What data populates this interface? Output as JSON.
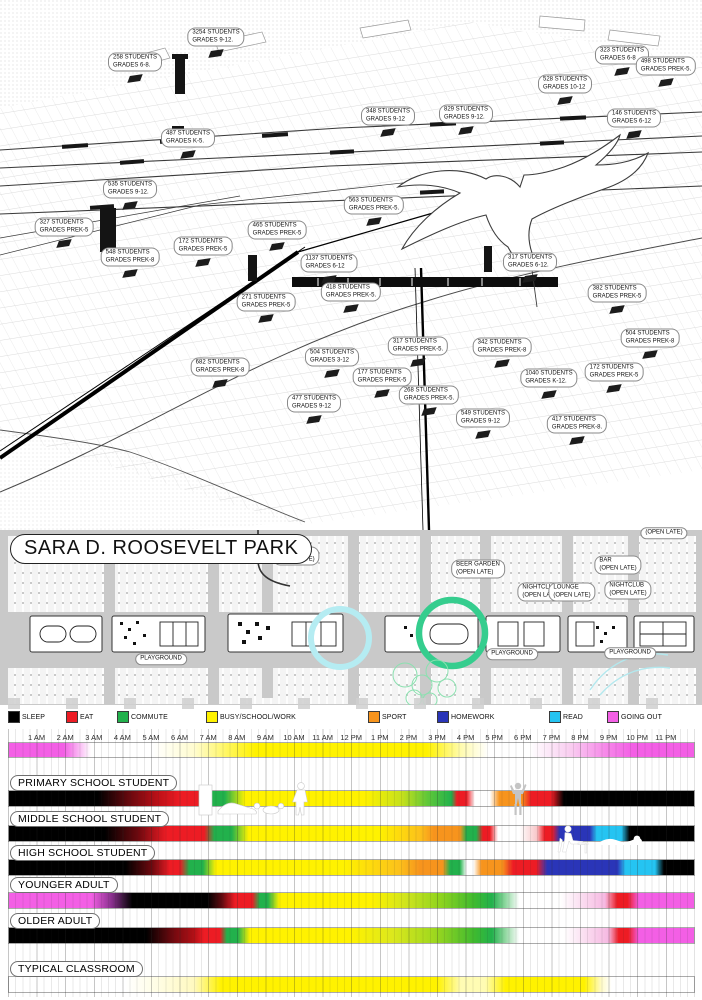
{
  "map": {
    "schools": [
      {
        "students": "3254 STUDENTS",
        "grades": "GRADES 9-12.",
        "x": 216,
        "y": 37
      },
      {
        "students": "258 STUDENTS",
        "grades": "GRADES 6-8.",
        "x": 135,
        "y": 62
      },
      {
        "students": "487 STUDENTS",
        "grades": "GRADES K-5.",
        "x": 188,
        "y": 138
      },
      {
        "students": "535 STUDENTS",
        "grades": "GRADES 9-12.",
        "x": 130,
        "y": 189
      },
      {
        "students": "327 STUDENTS",
        "grades": "GRADES PREK-5",
        "x": 64,
        "y": 227
      },
      {
        "students": "548 STUDENTS",
        "grades": "GRADES PREK-8",
        "x": 130,
        "y": 257
      },
      {
        "students": "172 STUDENTS",
        "grades": "GRADES PREK-5",
        "x": 203,
        "y": 246
      },
      {
        "students": "465 STUDENTS",
        "grades": "GRADES PREK-5",
        "x": 277,
        "y": 230
      },
      {
        "students": "1137 STUDENTS",
        "grades": "GRADES 6-12",
        "x": 329,
        "y": 263
      },
      {
        "students": "418 STUDENTS",
        "grades": "GRADES PREK-5.",
        "x": 351,
        "y": 292
      },
      {
        "students": "348 STUDENTS",
        "grades": "GRADES 9-12",
        "x": 388,
        "y": 116
      },
      {
        "students": "829 STUDENTS",
        "grades": "GRADES 9-12.",
        "x": 466,
        "y": 114
      },
      {
        "students": "528 STUDENTS",
        "grades": "GRADES 10-12",
        "x": 565,
        "y": 84
      },
      {
        "students": "323 STUDENTS",
        "grades": "GRADES 6-8",
        "x": 622,
        "y": 55
      },
      {
        "students": "498 STUDENTS",
        "grades": "GRADES PREK-5.",
        "x": 666,
        "y": 66
      },
      {
        "students": "146 STUDENTS",
        "grades": "GRADES 6-12",
        "x": 634,
        "y": 118
      },
      {
        "students": "563 STUDENTS",
        "grades": "GRADES PREK-5.",
        "x": 374,
        "y": 205
      },
      {
        "students": "317 STUDENTS",
        "grades": "GRADES 6-12.",
        "x": 530,
        "y": 262
      },
      {
        "students": "271 STUDENTS",
        "grades": "GRADES PREK-5",
        "x": 266,
        "y": 302
      },
      {
        "students": "682 STUDENTS",
        "grades": "GRADES PREK-8",
        "x": 220,
        "y": 367
      },
      {
        "students": "504 STUDENTS",
        "grades": "GRADES 3-12",
        "x": 332,
        "y": 357
      },
      {
        "students": "477 STUDENTS",
        "grades": "GRADES 9-12",
        "x": 314,
        "y": 403
      },
      {
        "students": "382 STUDENTS",
        "grades": "GRADES PREK-5",
        "x": 617,
        "y": 293
      },
      {
        "students": "504 STUDENTS",
        "grades": "GRADES PREK-8",
        "x": 650,
        "y": 338
      },
      {
        "students": "172 STUDENTS",
        "grades": "GRADES PREK-5",
        "x": 614,
        "y": 372
      },
      {
        "students": "317 STUDENTS",
        "grades": "GRADES PREK-5.",
        "x": 418,
        "y": 346
      },
      {
        "students": "342 STUDENTS",
        "grades": "GRADES PREK-8",
        "x": 502,
        "y": 347
      },
      {
        "students": "177 STUDENTS",
        "grades": "GRADES PREK-5",
        "x": 382,
        "y": 377
      },
      {
        "students": "1040 STUDENTS",
        "grades": "GRADES K-12.",
        "x": 549,
        "y": 378
      },
      {
        "students": "268 STUDENTS",
        "grades": "GRADES PREK-5.",
        "x": 429,
        "y": 395
      },
      {
        "students": "549 STUDENTS",
        "grades": "GRADES 9-12",
        "x": 483,
        "y": 418
      },
      {
        "students": "417 STUDENTS",
        "grades": "GRADES PREK-8.",
        "x": 577,
        "y": 424
      }
    ]
  },
  "park": {
    "title": "SARA D. ROOSEVELT PARK",
    "venues": [
      {
        "name": "NIGHTCLUB",
        "note": "(OPEN LATE)",
        "x": 296,
        "y": 556
      },
      {
        "name": "",
        "note": "(OPEN LATE)",
        "x": 664,
        "y": 533
      },
      {
        "name": "BEER GARDEN",
        "note": "(OPEN LATE)",
        "x": 478,
        "y": 569
      },
      {
        "name": "NIGHTCLUB",
        "note": "(OPEN LATE)",
        "x": 541,
        "y": 592
      },
      {
        "name": "LOUNGE",
        "note": "(OPEN LATE)",
        "x": 572,
        "y": 592
      },
      {
        "name": "BAR",
        "note": "(OPEN LATE)",
        "x": 618,
        "y": 565
      },
      {
        "name": "NIGHTCLUB",
        "note": "(OPEN LATE)",
        "x": 628,
        "y": 590
      }
    ],
    "playgrounds": [
      {
        "label": "PLAYGROUND",
        "x": 161,
        "y": 659
      },
      {
        "label": "PLAYGROUND",
        "x": 512,
        "y": 654
      },
      {
        "label": "PLAYGROUND",
        "x": 630,
        "y": 653
      }
    ]
  },
  "chart_data": {
    "type": "timeline",
    "x_axis": {
      "tick_labels": [
        "1 AM",
        "2 AM",
        "3 AM",
        "4 AM",
        "5 AM",
        "6 AM",
        "7 AM",
        "8 AM",
        "9 AM",
        "10 AM",
        "11 AM",
        "12 PM",
        "1 PM",
        "2 PM",
        "3 PM",
        "4 PM",
        "5 PM",
        "6 PM",
        "7 PM",
        "8 PM",
        "9 PM",
        "10 PM",
        "11 PM"
      ],
      "start_hour": 0,
      "end_hour": 24,
      "minor_grid_minutes": 15
    },
    "legend": [
      {
        "label": "SLEEP",
        "color": "#000000"
      },
      {
        "label": "EAT",
        "color": "#ed1c24"
      },
      {
        "label": "COMMUTE",
        "color": "#22b14c"
      },
      {
        "label": "BUSY/SCHOOL/WORK",
        "color": "#fff200"
      },
      {
        "label": "SPORT",
        "color": "#f7941d"
      },
      {
        "label": "HOMEWORK",
        "color": "#2a35b8"
      },
      {
        "label": "READ",
        "color": "#25c4f2"
      },
      {
        "label": "GOING OUT",
        "color": "#f35fe5"
      }
    ],
    "rows": [
      {
        "label": "",
        "stops": [
          [
            0,
            "#f35fe5"
          ],
          [
            8,
            "#f35fe5"
          ],
          [
            12,
            "#ffffff"
          ],
          [
            21,
            "#ffffff"
          ],
          [
            27,
            "#fffcd0"
          ],
          [
            36,
            "#fff200"
          ],
          [
            61,
            "#fff200"
          ],
          [
            66,
            "#fffbb0"
          ],
          [
            70,
            "#ffffff"
          ],
          [
            76,
            "#ffffff"
          ],
          [
            82,
            "#f9cdf0"
          ],
          [
            87,
            "#f68ae9"
          ],
          [
            91,
            "#f35fe5"
          ],
          [
            100,
            "#f35fe5"
          ]
        ]
      },
      {
        "label": "PRIMARY SCHOOL STUDENT",
        "stops": [
          [
            0,
            "#000000"
          ],
          [
            13,
            "#000000"
          ],
          [
            18,
            "#72090f"
          ],
          [
            22,
            "#c11118"
          ],
          [
            25,
            "#ed1c24"
          ],
          [
            27.5,
            "#ed1c24"
          ],
          [
            29,
            "#22b14c"
          ],
          [
            31.5,
            "#22b14c"
          ],
          [
            34.5,
            "#fff200"
          ],
          [
            52,
            "#fff200"
          ],
          [
            57.5,
            "#c3e01d"
          ],
          [
            61,
            "#62c838"
          ],
          [
            64.6,
            "#22b14c"
          ],
          [
            65.4,
            "#ed1c24"
          ],
          [
            66.8,
            "#ed1c24"
          ],
          [
            68,
            "#ffffff"
          ],
          [
            70.2,
            "#ffffff"
          ],
          [
            71.6,
            "#f7941d"
          ],
          [
            74.8,
            "#f7941d"
          ],
          [
            76.2,
            "#ed1c24"
          ],
          [
            79.2,
            "#ed1c24"
          ],
          [
            81,
            "#000000"
          ],
          [
            100,
            "#000000"
          ]
        ]
      },
      {
        "label": "MIDDLE SCHOOL STUDENT",
        "stops": [
          [
            0,
            "#000000"
          ],
          [
            14,
            "#000000"
          ],
          [
            19,
            "#72090f"
          ],
          [
            23,
            "#ed1c24"
          ],
          [
            28.5,
            "#ed1c24"
          ],
          [
            30,
            "#22b14c"
          ],
          [
            32.5,
            "#22b14c"
          ],
          [
            35,
            "#fff200"
          ],
          [
            54,
            "#fff200"
          ],
          [
            60,
            "#fcc11b"
          ],
          [
            62,
            "#f7941d"
          ],
          [
            65.8,
            "#f7941d"
          ],
          [
            66.8,
            "#22b14c"
          ],
          [
            68.2,
            "#22b14c"
          ],
          [
            69.2,
            "#ed1c24"
          ],
          [
            70.2,
            "#ed1c24"
          ],
          [
            71.4,
            "#ffffff"
          ],
          [
            74.5,
            "#ffffff"
          ],
          [
            77,
            "#f8c9cb"
          ],
          [
            78.2,
            "#ed1c24"
          ],
          [
            79.3,
            "#ed1c24"
          ],
          [
            80.4,
            "#2a35b8"
          ],
          [
            84.8,
            "#2a35b8"
          ],
          [
            85.8,
            "#25c4f2"
          ],
          [
            89.4,
            "#25c4f2"
          ],
          [
            90.6,
            "#000000"
          ],
          [
            100,
            "#000000"
          ]
        ]
      },
      {
        "label": "HIGH SCHOOL STUDENT",
        "stops": [
          [
            0,
            "#000000"
          ],
          [
            17,
            "#000000"
          ],
          [
            21,
            "#72090f"
          ],
          [
            23.5,
            "#ed1c24"
          ],
          [
            25,
            "#ed1c24"
          ],
          [
            26.3,
            "#22b14c"
          ],
          [
            28.3,
            "#22b14c"
          ],
          [
            30.2,
            "#fff200"
          ],
          [
            49,
            "#fff200"
          ],
          [
            57,
            "#fcc11b"
          ],
          [
            60,
            "#f7941d"
          ],
          [
            63.3,
            "#f7941d"
          ],
          [
            64.4,
            "#22b14c"
          ],
          [
            65.8,
            "#22b14c"
          ],
          [
            66.8,
            "#ffffff"
          ],
          [
            67.8,
            "#ffffff"
          ],
          [
            69,
            "#f7941d"
          ],
          [
            72,
            "#f7941d"
          ],
          [
            73.6,
            "#ed1c24"
          ],
          [
            77,
            "#ed1c24"
          ],
          [
            78.6,
            "#2a35b8"
          ],
          [
            88.8,
            "#2a35b8"
          ],
          [
            90,
            "#25c4f2"
          ],
          [
            94.3,
            "#25c4f2"
          ],
          [
            95.6,
            "#000000"
          ],
          [
            100,
            "#000000"
          ]
        ]
      },
      {
        "label": "YOUNGER ADULT",
        "stops": [
          [
            0,
            "#f35fe5"
          ],
          [
            12,
            "#f35fe5"
          ],
          [
            15,
            "#89308d"
          ],
          [
            18,
            "#000000"
          ],
          [
            29,
            "#000000"
          ],
          [
            31,
            "#5c090e"
          ],
          [
            33,
            "#ed1c24"
          ],
          [
            35.5,
            "#ed1c24"
          ],
          [
            36.6,
            "#22b14c"
          ],
          [
            37.8,
            "#22b14c"
          ],
          [
            39.5,
            "#fff200"
          ],
          [
            53,
            "#fff200"
          ],
          [
            58,
            "#cfe41e"
          ],
          [
            63,
            "#8fd41e"
          ],
          [
            68,
            "#3eba30"
          ],
          [
            70.5,
            "#22b14c"
          ],
          [
            72.5,
            "#8fd8a0"
          ],
          [
            74.5,
            "#ffffff"
          ],
          [
            80.5,
            "#ffffff"
          ],
          [
            84,
            "#fad9ef"
          ],
          [
            87,
            "#f6b9e2"
          ],
          [
            88.8,
            "#ed1c24"
          ],
          [
            90.3,
            "#ed1c24"
          ],
          [
            92,
            "#f35fe5"
          ],
          [
            100,
            "#f35fe5"
          ]
        ]
      },
      {
        "label": "OLDER ADULT",
        "stops": [
          [
            0,
            "#000000"
          ],
          [
            20,
            "#000000"
          ],
          [
            24,
            "#72090f"
          ],
          [
            27,
            "#b21016"
          ],
          [
            28.5,
            "#ed1c24"
          ],
          [
            30.8,
            "#ed1c24"
          ],
          [
            31.8,
            "#22b14c"
          ],
          [
            33.4,
            "#22b14c"
          ],
          [
            35.2,
            "#fff200"
          ],
          [
            50,
            "#fff200"
          ],
          [
            56,
            "#dce81d"
          ],
          [
            62,
            "#a0d81e"
          ],
          [
            68,
            "#3eba30"
          ],
          [
            70.5,
            "#22b14c"
          ],
          [
            72.5,
            "#93d8a2"
          ],
          [
            74.5,
            "#ffffff"
          ],
          [
            81,
            "#ffffff"
          ],
          [
            84.5,
            "#fad9ef"
          ],
          [
            87.5,
            "#f6b9e2"
          ],
          [
            89,
            "#ed1c24"
          ],
          [
            90.4,
            "#ed1c24"
          ],
          [
            92,
            "#f35fe5"
          ],
          [
            100,
            "#f35fe5"
          ]
        ]
      },
      {
        "label": "TYPICAL CLASSROOM",
        "stops": [
          [
            0,
            "#ffffff"
          ],
          [
            17,
            "#ffffff"
          ],
          [
            22,
            "#fffde2"
          ],
          [
            27,
            "#fff9c0"
          ],
          [
            31,
            "#fff200"
          ],
          [
            62.5,
            "#fff200"
          ],
          [
            66,
            "#fffcb4"
          ],
          [
            69.5,
            "#fffcb4"
          ],
          [
            72.5,
            "#fff200"
          ],
          [
            84,
            "#fff200"
          ],
          [
            86.5,
            "#fffbca"
          ],
          [
            88,
            "#ffffff"
          ],
          [
            100,
            "#ffffff"
          ]
        ]
      }
    ]
  }
}
